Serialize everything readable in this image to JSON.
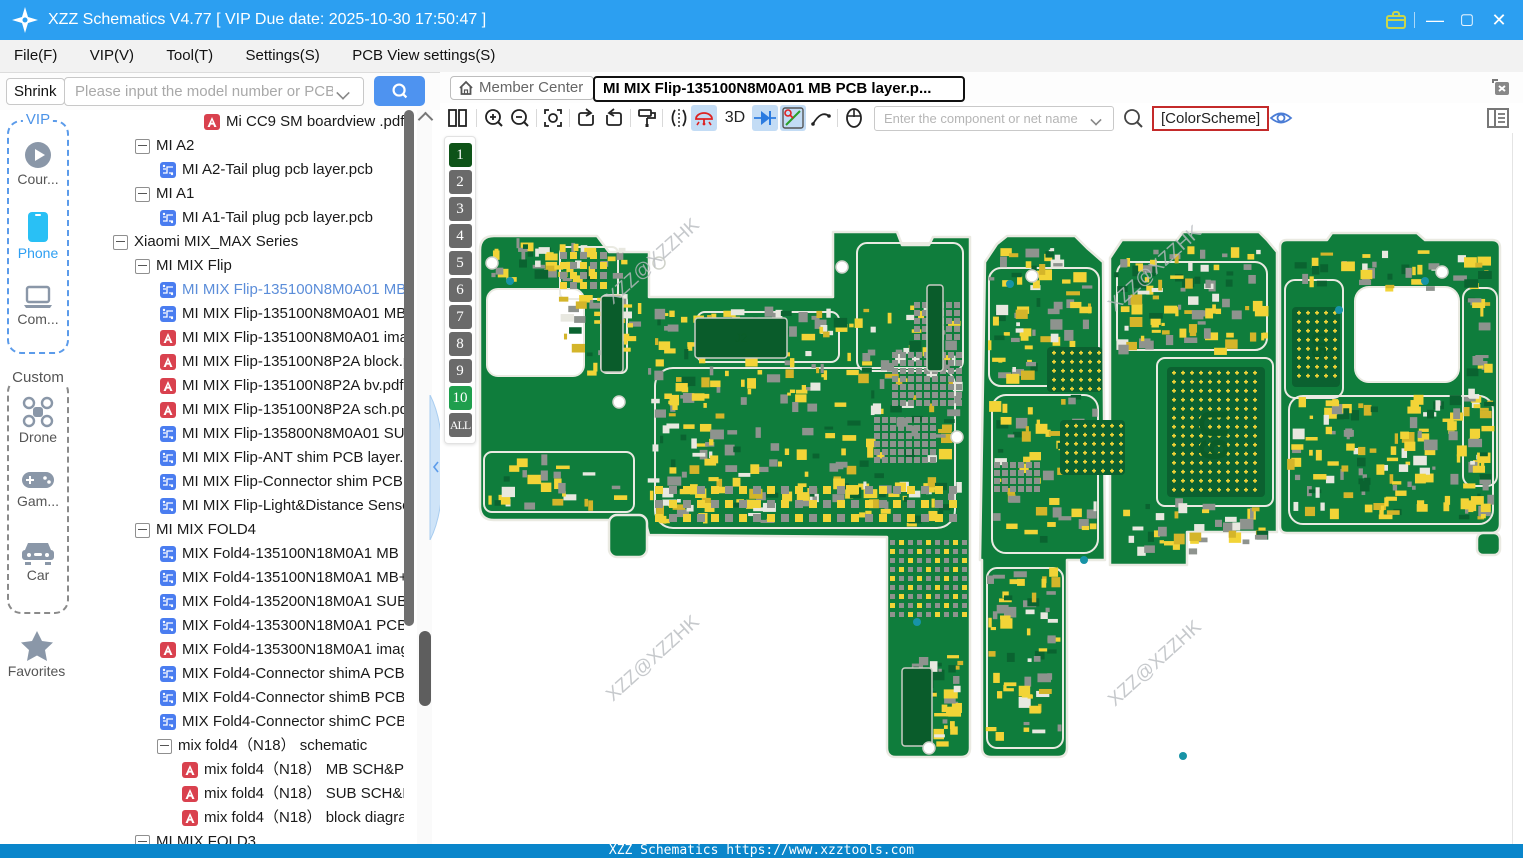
{
  "window": {
    "title": "XZZ Schematics V4.77 [ VIP Due date: 2025-10-30 17:50:47 ]"
  },
  "menu": {
    "items": [
      "File(F)",
      "VIP(V)",
      "Tool(T)",
      "Settings(S)",
      "PCB View settings(S)"
    ]
  },
  "library": {
    "shrink_label": "Shrink",
    "search_placeholder": "Please input the model number or PCB"
  },
  "viewer": {
    "member_center_label": "Member Center",
    "tab_title": "MI MIX Flip-135100N8M0A01 MB PCB layer.p...",
    "threed_label": "3D",
    "net_search_placeholder": "Enter the component or net name",
    "color_scheme_label": "[ColorScheme]"
  },
  "sidebar": {
    "vip_group_label": "VIP",
    "custom_group_label": "Custom",
    "items": [
      {
        "label": "Cour...",
        "icon": "play-icon",
        "group": "vip"
      },
      {
        "label": "Phone",
        "icon": "phone-icon",
        "group": "vip",
        "active": true
      },
      {
        "label": "Com...",
        "icon": "laptop-icon",
        "group": "vip"
      },
      {
        "label": "Drone",
        "icon": "drone-icon",
        "group": "custom"
      },
      {
        "label": "Gam...",
        "icon": "gamepad-icon",
        "group": "custom"
      },
      {
        "label": "Car",
        "icon": "car-icon",
        "group": "custom"
      }
    ],
    "favorites_label": "Favorites"
  },
  "tree": {
    "rows": [
      {
        "type": "pdf",
        "indent": 4,
        "label": "Mi CC9 SM boardview .pdf"
      },
      {
        "type": "folder",
        "indent": 1,
        "label": "MI A2"
      },
      {
        "type": "pcb",
        "indent": 2,
        "label": "MI A2-Tail plug pcb layer.pcb"
      },
      {
        "type": "folder",
        "indent": 1,
        "label": "MI A1"
      },
      {
        "type": "pcb",
        "indent": 2,
        "label": "MI A1-Tail plug pcb layer.pcb"
      },
      {
        "type": "folder",
        "indent": 0,
        "label": "Xiaomi MIX_MAX Series"
      },
      {
        "type": "folder",
        "indent": 1,
        "label": "MI MIX Flip"
      },
      {
        "type": "pcb",
        "indent": 2,
        "label": "MI MIX Flip-135100N8M0A01 MB PCB layer.pcb",
        "selected": true
      },
      {
        "type": "pcb",
        "indent": 2,
        "label": "MI MIX Flip-135100N8M0A01 MB+SUB PCB layer.pcb"
      },
      {
        "type": "pdf",
        "indent": 2,
        "label": "MI MIX Flip-135100N8M0A01 image.pdf"
      },
      {
        "type": "pdf",
        "indent": 2,
        "label": "MI MIX Flip-135100N8P2A block.pdf"
      },
      {
        "type": "pdf",
        "indent": 2,
        "label": "MI MIX Flip-135100N8P2A bv.pdf"
      },
      {
        "type": "pdf",
        "indent": 2,
        "label": "MI MIX Flip-135100N8P2A sch.pdf"
      },
      {
        "type": "pcb",
        "indent": 2,
        "label": "MI MIX Flip-135800N8M0A01 SUB PCB layer.pcb"
      },
      {
        "type": "pcb",
        "indent": 2,
        "label": "MI MIX Flip-ANT shim PCB layer.pcb"
      },
      {
        "type": "pcb",
        "indent": 2,
        "label": "MI MIX Flip-Connector shim PCB layer.pcb"
      },
      {
        "type": "pcb",
        "indent": 2,
        "label": "MI MIX Flip-Light&Distance Sensor PCB layer.pcb"
      },
      {
        "type": "folder",
        "indent": 1,
        "label": "MI MIX FOLD4"
      },
      {
        "type": "pcb",
        "indent": 2,
        "label": "MIX Fold4-135100N18M0A1 MB PCB layer.pcb"
      },
      {
        "type": "pcb",
        "indent": 2,
        "label": "MIX Fold4-135100N18M0A1 MB+SUB PCB layer.pcb"
      },
      {
        "type": "pcb",
        "indent": 2,
        "label": "MIX Fold4-135200N18M0A1 SUB PCB layer.pcb"
      },
      {
        "type": "pcb",
        "indent": 2,
        "label": "MIX Fold4-135300N18M0A1 PCB layer.pcb"
      },
      {
        "type": "pdf",
        "indent": 2,
        "label": "MIX Fold4-135300N18M0A1 image.pdf"
      },
      {
        "type": "pcb",
        "indent": 2,
        "label": "MIX Fold4-Connector shimA PCB layer.pcb"
      },
      {
        "type": "pcb",
        "indent": 2,
        "label": "MIX Fold4-Connector shimB PCB layer.pcb"
      },
      {
        "type": "pcb",
        "indent": 2,
        "label": "MIX Fold4-Connector shimC PCB layer.pcb"
      },
      {
        "type": "folder",
        "indent": 2,
        "label": "mix fold4（N18） schematic"
      },
      {
        "type": "pdf",
        "indent": 3,
        "label": "mix fold4（N18） MB SCH&PCB"
      },
      {
        "type": "pdf",
        "indent": 3,
        "label": "mix fold4（N18） SUB SCH&PCB"
      },
      {
        "type": "pdf",
        "indent": 3,
        "label": "mix fold4（N18） block diagram"
      },
      {
        "type": "folder",
        "indent": 1,
        "label": "MI MIX FOLD3"
      }
    ]
  },
  "layers": {
    "items": [
      {
        "label": "1",
        "state": "top"
      },
      {
        "label": "2",
        "state": ""
      },
      {
        "label": "3",
        "state": ""
      },
      {
        "label": "4",
        "state": ""
      },
      {
        "label": "5",
        "state": ""
      },
      {
        "label": "6",
        "state": ""
      },
      {
        "label": "7",
        "state": ""
      },
      {
        "label": "8",
        "state": ""
      },
      {
        "label": "9",
        "state": ""
      },
      {
        "label": "10",
        "state": "bottom"
      },
      {
        "label": "ALL",
        "state": "all"
      }
    ]
  },
  "pcb": {
    "watermark": "XZZ@XZZHK",
    "labels": {
      "u9": "U9",
      "u5": "U5",
      "j2": "J2"
    }
  },
  "footer": {
    "text": "XZZ Schematics https://www.xzztools.com"
  },
  "colors": {
    "titlebar": "#2C9FF1",
    "footer": "#0A86CB",
    "board_green": "#0F7D3C",
    "pad_yellow": "#F2D437",
    "silkscreen": "#EAEAE2",
    "layer_top": "#0E5318",
    "layer_bottom": "#1F9E4D",
    "selection_blue": "#5B8DD9",
    "tool_active_bg": "#C3DCF5"
  }
}
